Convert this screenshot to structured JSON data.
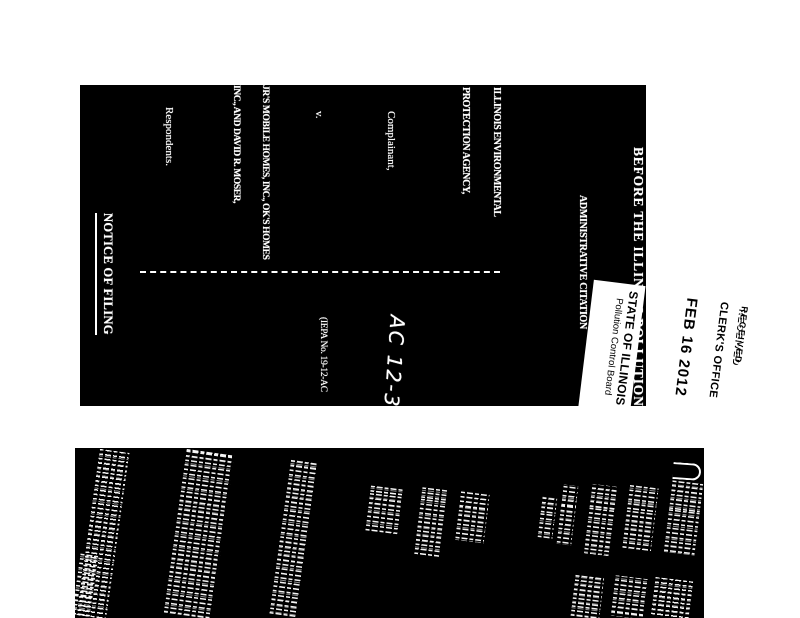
{
  "colors": {
    "paper": "#ffffff",
    "scan_background": "#000000",
    "scan_text": "#ffffff",
    "stamp_ink": "#000000"
  },
  "document": {
    "court_title": "BEFORE THE ILLINOIS POLLUTION CONTROL BOARD",
    "agency_line1": "ILLINOIS ENVIRONMENTAL",
    "agency_line2": "PROTECTION AGENCY,",
    "complainant_label": "Complainant,",
    "versus": "v.",
    "respondent_line1": "JR'S MOBILE HOMES, INC., OK'S HOMES",
    "respondent_line2": "INC., AND DAVID R. MOSER,",
    "respondents_label": "Respondents.",
    "docket_handwritten": "AC 12-30",
    "iepa_case_number": "(IEPA No. 19-12-AC",
    "case_type_heading": "ADMINISTRATIVE CITATION",
    "notice_heading": "NOTICE OF FILING"
  },
  "stamp": {
    "received_label": "RECEIVED",
    "office_label": "CLERK'S OFFICE",
    "date_stamp": "FEB 16 2012",
    "state_label": "STATE OF ILLINOIS",
    "board_label": "Pollution Control Board"
  },
  "second_page": {
    "legibility": "illegible rotated scanned text",
    "columns": [
      {
        "x": 13,
        "y": 2,
        "w": 30,
        "h": 168,
        "tilt": 8
      },
      {
        "x": 100,
        "y": 2,
        "w": 48,
        "h": 168,
        "tilt": 8
      },
      {
        "x": 205,
        "y": 12,
        "w": 27,
        "h": 158,
        "tilt": 8
      },
      {
        "x": 293,
        "y": 38,
        "w": 34,
        "h": 48,
        "tilt": 7
      },
      {
        "x": 343,
        "y": 40,
        "w": 25,
        "h": 70,
        "tilt": 7
      },
      {
        "x": 383,
        "y": 44,
        "w": 29,
        "h": 50,
        "tilt": 7
      },
      {
        "x": 465,
        "y": 48,
        "w": 15,
        "h": 43,
        "tilt": 7
      },
      {
        "x": 485,
        "y": 37,
        "w": 15,
        "h": 60,
        "tilt": 7
      },
      {
        "x": 513,
        "y": 37,
        "w": 25,
        "h": 70,
        "tilt": 7
      },
      {
        "x": 551,
        "y": 37,
        "w": 29,
        "h": 66,
        "tilt": 7
      },
      {
        "x": 593,
        "y": 33,
        "w": 31,
        "h": 74,
        "tilt": 7
      },
      {
        "x": 498,
        "y": 126,
        "w": 29,
        "h": 44,
        "tilt": 7
      },
      {
        "x": 538,
        "y": 129,
        "w": 34,
        "h": 41,
        "tilt": 7
      },
      {
        "x": 578,
        "y": 131,
        "w": 38,
        "h": 39,
        "tilt": 7
      },
      {
        "x": 1,
        "y": 106,
        "w": 18,
        "h": 64,
        "tilt": 8
      }
    ]
  }
}
